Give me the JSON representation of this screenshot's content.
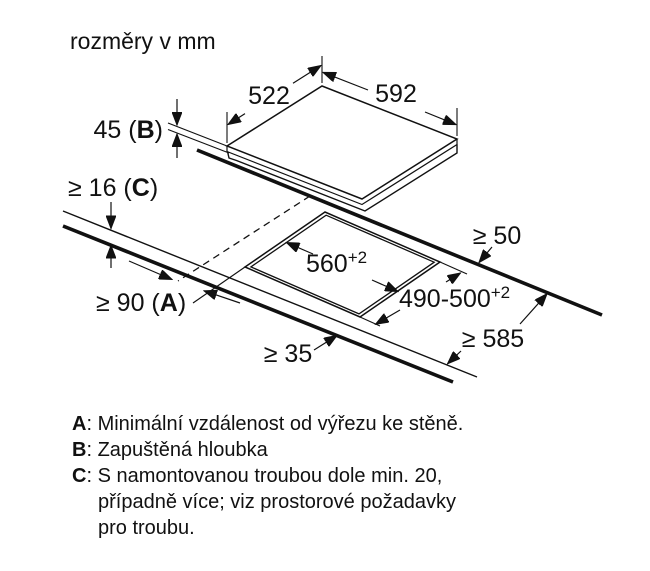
{
  "title": "rozměry v mm",
  "diagram": {
    "dim_522": "522",
    "dim_592": "592",
    "dim_45_prefix": "45 (",
    "dim_45_letter": "B",
    "dim_45_suffix": ")",
    "dim_16_prefix": "≥ 16 (",
    "dim_16_letter": "C",
    "dim_16_suffix": ")",
    "dim_90_prefix": "≥ 90 (",
    "dim_90_letter": "A",
    "dim_90_suffix": ")",
    "dim_560_main": "560",
    "dim_560_sup": "+2",
    "dim_490_main": "490-500",
    "dim_490_sup": "+2",
    "dim_50": "≥ 50",
    "dim_585": "≥ 585",
    "dim_35": "≥ 35"
  },
  "legend": [
    {
      "letter": "A",
      "text": ": Minimální vzdálenost od výřezu ke stěně."
    },
    {
      "letter": "B",
      "text": ": Zapuštěná hloubka"
    },
    {
      "letter": "C",
      "text": ": S namontovanou troubou dole min. 20,"
    },
    {
      "letter": "",
      "text": "případně více; viz prostorové požadavky"
    },
    {
      "letter": "",
      "text": "pro troubu."
    }
  ]
}
